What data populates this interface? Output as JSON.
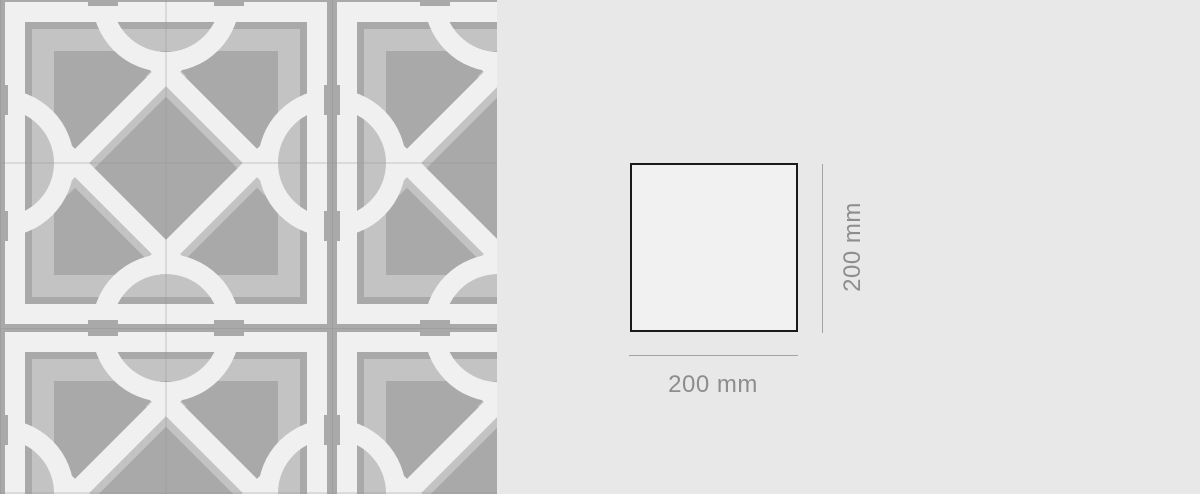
{
  "page": {
    "background_color": "#e8e8e8",
    "description": "Product view: patterned cement tile swatch with 200 x 200 mm dimension diagram"
  },
  "swatch": {
    "kind": "tile-pattern-photo",
    "tiles_visible": "3 x 3",
    "base_color": "#a9a9a9",
    "motif_color": "#f0f0f0",
    "inner_frame_color": "#c3c3c3",
    "joint_line_color": "#8f8f8f"
  },
  "dimension_diagram": {
    "width_label": "200 mm",
    "height_label": "200 mm",
    "outline_color": "#1a1a1a",
    "face_color": "#f1f1f1",
    "dimension_line_color": "#a3a3a3",
    "label_color": "#8d8d8d"
  }
}
